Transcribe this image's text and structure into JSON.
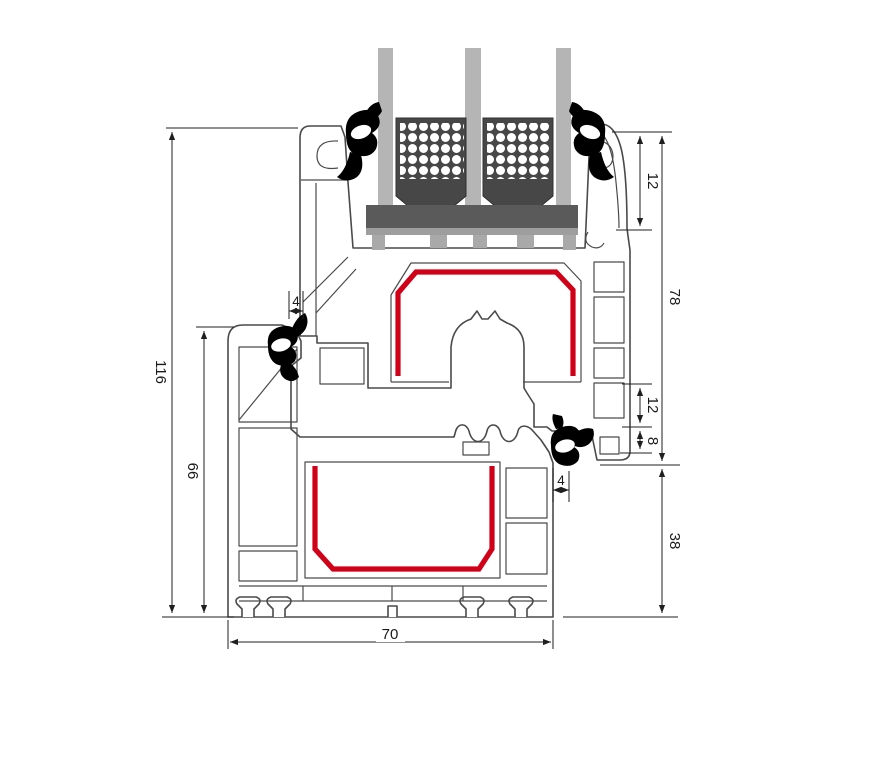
{
  "drawing": {
    "title": "window-profile-cross-section",
    "type": "technical-section"
  },
  "dimensions": {
    "overall_height": "116",
    "frame_height": "66",
    "gasket_top": "4",
    "glazing_depth": "12",
    "sash_height": "78",
    "hardware_groove": "12",
    "step": "8",
    "gasket_bottom": "4",
    "frame_face": "38",
    "profile_width": "70"
  },
  "colors": {
    "background": "#ffffff",
    "profile_outline": "#4a4a4a",
    "dimension_line": "#1f1f1f",
    "steel_reinforcement": "#d10019",
    "glass": "#b5b5b5",
    "spacer": "#474747",
    "glazing_block": "#5a5a5a",
    "glazing_bridge": "#9e9e9e",
    "gasket": "#000000"
  }
}
